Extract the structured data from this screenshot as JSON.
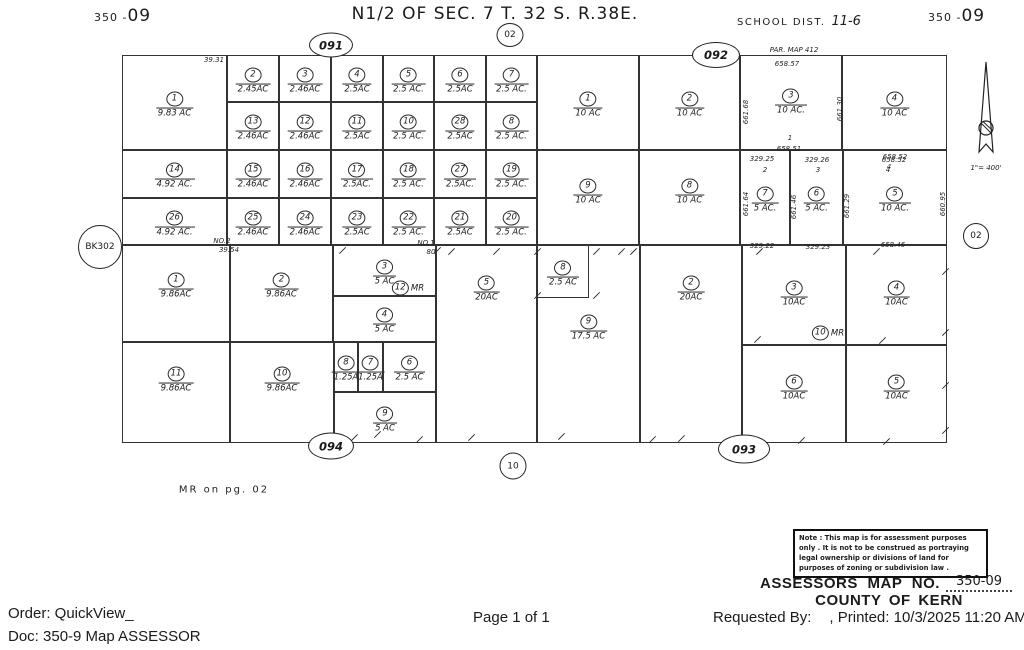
{
  "colors": {
    "paper": "#ffffff",
    "line": "#333333",
    "ink": "#1b1b1b"
  },
  "header": {
    "sheet_prefix": "350 -",
    "sheet_number": "09",
    "title": "N1/2 OF SEC. 7  T. 32 S. R.38E.",
    "school_label": "SCHOOL DIST.",
    "school_value": "11-6"
  },
  "map": {
    "parcels": [
      {
        "n": "1",
        "a": "9.83 AC",
        "x": 122,
        "y": 55,
        "w": 105,
        "h": 95
      },
      {
        "n": "2",
        "a": "2.45AC",
        "x": 227,
        "y": 55,
        "w": 52,
        "h": 47
      },
      {
        "n": "3",
        "a": "2.46AC",
        "x": 279,
        "y": 55,
        "w": 52,
        "h": 47
      },
      {
        "n": "4",
        "a": "2.5AC",
        "x": 331,
        "y": 55,
        "w": 52,
        "h": 47
      },
      {
        "n": "5",
        "a": "2.5 AC.",
        "x": 383,
        "y": 55,
        "w": 51,
        "h": 47
      },
      {
        "n": "6",
        "a": "2.5AC",
        "x": 434,
        "y": 55,
        "w": 52,
        "h": 47
      },
      {
        "n": "7",
        "a": "2.5 AC.",
        "x": 486,
        "y": 55,
        "w": 51,
        "h": 47
      },
      {
        "n": "13",
        "a": "2.46AC",
        "x": 227,
        "y": 102,
        "w": 52,
        "h": 48
      },
      {
        "n": "12",
        "a": "2.46AC",
        "x": 279,
        "y": 102,
        "w": 52,
        "h": 48
      },
      {
        "n": "11",
        "a": "2.5AC",
        "x": 331,
        "y": 102,
        "w": 52,
        "h": 48
      },
      {
        "n": "10",
        "a": "2.5 AC.",
        "x": 383,
        "y": 102,
        "w": 51,
        "h": 48
      },
      {
        "n": "28",
        "a": "2.5AC",
        "x": 434,
        "y": 102,
        "w": 52,
        "h": 48
      },
      {
        "n": "8",
        "a": "2.5 AC.",
        "x": 486,
        "y": 102,
        "w": 51,
        "h": 48
      },
      {
        "n": "14",
        "a": "4.92 AC.",
        "x": 122,
        "y": 150,
        "w": 105,
        "h": 48
      },
      {
        "n": "15",
        "a": "2.46AC",
        "x": 227,
        "y": 150,
        "w": 52,
        "h": 48
      },
      {
        "n": "16",
        "a": "2.46AC",
        "x": 279,
        "y": 150,
        "w": 52,
        "h": 48
      },
      {
        "n": "17",
        "a": "2.5AC.",
        "x": 331,
        "y": 150,
        "w": 52,
        "h": 48
      },
      {
        "n": "18",
        "a": "2.5 AC.",
        "x": 383,
        "y": 150,
        "w": 51,
        "h": 48
      },
      {
        "n": "27",
        "a": "2.5AC.",
        "x": 434,
        "y": 150,
        "w": 52,
        "h": 48
      },
      {
        "n": "19",
        "a": "2.5 AC.",
        "x": 486,
        "y": 150,
        "w": 51,
        "h": 48
      },
      {
        "n": "26",
        "a": "4.92 AC.",
        "x": 122,
        "y": 198,
        "w": 105,
        "h": 47
      },
      {
        "n": "25",
        "a": "2.46AC",
        "x": 227,
        "y": 198,
        "w": 52,
        "h": 47
      },
      {
        "n": "24",
        "a": "2.46AC",
        "x": 279,
        "y": 198,
        "w": 52,
        "h": 47
      },
      {
        "n": "23",
        "a": "2.5AC",
        "x": 331,
        "y": 198,
        "w": 52,
        "h": 47
      },
      {
        "n": "22",
        "a": "2.5 AC.",
        "x": 383,
        "y": 198,
        "w": 51,
        "h": 47
      },
      {
        "n": "21",
        "a": "2.5AC",
        "x": 434,
        "y": 198,
        "w": 52,
        "h": 47
      },
      {
        "n": "20",
        "a": "2.5 AC.",
        "x": 486,
        "y": 198,
        "w": 51,
        "h": 47
      },
      {
        "n": "1",
        "a": "10 AC",
        "x": 537,
        "y": 55,
        "w": 102,
        "h": 95
      },
      {
        "n": "2",
        "a": "10 AC",
        "x": 639,
        "y": 55,
        "w": 101,
        "h": 95
      },
      {
        "n": "3",
        "a": "10 AC.",
        "x": 740,
        "y": 55,
        "w": 102,
        "h": 95,
        "ly": 100
      },
      {
        "n": "4",
        "a": "10 AC",
        "x": 842,
        "y": 55,
        "w": 105,
        "h": 95,
        "ly": 103
      },
      {
        "n": "9",
        "a": "10 AC",
        "x": 537,
        "y": 150,
        "w": 102,
        "h": 95,
        "ly": 190
      },
      {
        "n": "8",
        "a": "10 AC",
        "x": 639,
        "y": 150,
        "w": 101,
        "h": 95,
        "ly": 190
      },
      {
        "n": "7",
        "a": "5 AC.",
        "x": 740,
        "y": 150,
        "w": 50,
        "h": 95,
        "ly": 198
      },
      {
        "n": "6",
        "a": "5 AC.",
        "x": 790,
        "y": 150,
        "w": 53,
        "h": 95,
        "ly": 198
      },
      {
        "n": "5",
        "a": "10 AC.",
        "x": 843,
        "y": 150,
        "w": 104,
        "h": 95,
        "ly": 198
      },
      {
        "n": "1",
        "a": "9.86AC",
        "x": 122,
        "y": 245,
        "w": 108,
        "h": 97,
        "ly": 284
      },
      {
        "n": "2",
        "a": "9.86AC",
        "x": 230,
        "y": 245,
        "w": 103,
        "h": 97,
        "ly": 284
      },
      {
        "n": "3",
        "a": "5 AC",
        "x": 333,
        "y": 245,
        "w": 103,
        "h": 51
      },
      {
        "n": "4",
        "a": "5 AC",
        "x": 333,
        "y": 296,
        "w": 103,
        "h": 46
      },
      {
        "n": "11",
        "a": "9.86AC",
        "x": 122,
        "y": 342,
        "w": 108,
        "h": 101,
        "ly": 378
      },
      {
        "n": "10",
        "a": "9.86AC",
        "x": 230,
        "y": 342,
        "w": 104,
        "h": 101,
        "ly": 378
      },
      {
        "n": "8",
        "a": "1.25A",
        "x": 334,
        "y": 342,
        "w": 24,
        "h": 50
      },
      {
        "n": "7",
        "a": "1.25A",
        "x": 358,
        "y": 342,
        "w": 25,
        "h": 50
      },
      {
        "n": "6",
        "a": "2.5 AC",
        "x": 383,
        "y": 342,
        "w": 53,
        "h": 50
      },
      {
        "n": "9",
        "a": "5 AC",
        "x": 334,
        "y": 392,
        "w": 102,
        "h": 51
      },
      {
        "n": "5",
        "a": "20AC",
        "x": 436,
        "y": 245,
        "w": 101,
        "h": 198,
        "ly": 287
      },
      {
        "n": "9",
        "a": "17.5 AC",
        "x": 537,
        "y": 245,
        "w": 103,
        "h": 198,
        "ly": 326
      },
      {
        "n": "8",
        "a": "2.5 AC",
        "x": 537,
        "y": 245,
        "w": 52,
        "h": 53
      },
      {
        "n": "2",
        "a": "20AC",
        "x": 640,
        "y": 245,
        "w": 102,
        "h": 198,
        "ly": 287
      },
      {
        "n": "3",
        "a": "10AC",
        "x": 742,
        "y": 245,
        "w": 104,
        "h": 100,
        "ly": 292
      },
      {
        "n": "4",
        "a": "10AC",
        "x": 846,
        "y": 245,
        "w": 101,
        "h": 100,
        "ly": 292
      },
      {
        "n": "6",
        "a": "10AC",
        "x": 742,
        "y": 345,
        "w": 104,
        "h": 98,
        "ly": 386
      },
      {
        "n": "5",
        "a": "10AC",
        "x": 846,
        "y": 345,
        "w": 101,
        "h": 98,
        "ly": 386
      }
    ],
    "labels": [
      {
        "t": "39.31",
        "x": 214,
        "y": 60
      },
      {
        "t": "NO.2",
        "x": 222,
        "y": 241
      },
      {
        "t": "39.54",
        "x": 229,
        "y": 250
      },
      {
        "t": "NO.1",
        "x": 426,
        "y": 243
      },
      {
        "t": "80",
        "x": 431,
        "y": 252
      },
      {
        "t": "PAR. MAP  412",
        "x": 794,
        "y": 50
      },
      {
        "t": "658.57",
        "x": 787,
        "y": 64
      },
      {
        "t": "1",
        "x": 790,
        "y": 138
      },
      {
        "t": "658.51",
        "x": 789,
        "y": 149
      },
      {
        "t": "329.25",
        "x": 762,
        "y": 159
      },
      {
        "t": "2",
        "x": 765,
        "y": 170
      },
      {
        "t": "329.26",
        "x": 817,
        "y": 160
      },
      {
        "t": "3",
        "x": 818,
        "y": 170
      },
      {
        "t": "658.52",
        "x": 894,
        "y": 160
      },
      {
        "t": "4",
        "x": 888,
        "y": 170
      },
      {
        "t": "329.22",
        "x": 762,
        "y": 246
      },
      {
        "t": "329.23",
        "x": 818,
        "y": 247
      },
      {
        "t": "658.46",
        "x": 893,
        "y": 245
      },
      {
        "t": "661.68",
        "x": 746,
        "y": 112,
        "r": 1
      },
      {
        "t": "661.30",
        "x": 840,
        "y": 109,
        "r": 1
      },
      {
        "t": "661.64",
        "x": 746,
        "y": 204,
        "r": 1
      },
      {
        "t": "661.46",
        "x": 794,
        "y": 207,
        "r": 1
      },
      {
        "t": "661.29",
        "x": 847,
        "y": 206,
        "r": 1
      },
      {
        "t": "660.95",
        "x": 943,
        "y": 204,
        "r": 1
      },
      {
        "t": "658.52",
        "x": 895,
        "y": 157
      },
      {
        "t": "4",
        "x": 889,
        "y": 167
      },
      {
        "t": "1\"= 400'",
        "x": 986,
        "y": 168
      },
      {
        "t": "MR on pg. 02",
        "x": 224,
        "y": 490,
        "cls": "print"
      }
    ],
    "badges": [
      {
        "t": "091",
        "x": 331,
        "y": 45,
        "w": 42,
        "h": 23,
        "cls": "oval"
      },
      {
        "t": "02",
        "x": 510,
        "y": 35,
        "w": 25,
        "h": 22,
        "cls": "circ"
      },
      {
        "t": "092",
        "x": 716,
        "y": 55,
        "w": 46,
        "h": 24,
        "cls": "oval"
      },
      {
        "t": "02",
        "x": 976,
        "y": 236,
        "w": 24,
        "h": 24,
        "cls": "circ"
      },
      {
        "t": "BK302",
        "x": 100,
        "y": 247,
        "w": 42,
        "h": 42,
        "cls": "circ"
      },
      {
        "t": "094",
        "x": 331,
        "y": 446,
        "w": 44,
        "h": 25,
        "cls": "oval"
      },
      {
        "t": "093",
        "x": 744,
        "y": 449,
        "w": 50,
        "h": 27,
        "cls": "oval"
      },
      {
        "t": "10",
        "x": 513,
        "y": 466,
        "w": 25,
        "h": 25,
        "cls": "circ"
      }
    ],
    "mr_notes": [
      {
        "n": "12",
        "t": "MR",
        "x": 408,
        "y": 288
      },
      {
        "n": "10",
        "t": "MR",
        "x": 828,
        "y": 333
      }
    ],
    "ticks": [
      [
        338,
        250
      ],
      [
        433,
        250
      ],
      [
        447,
        251
      ],
      [
        492,
        251
      ],
      [
        533,
        251
      ],
      [
        592,
        251
      ],
      [
        617,
        251
      ],
      [
        629,
        251
      ],
      [
        755,
        251
      ],
      [
        872,
        251
      ],
      [
        533,
        295
      ],
      [
        592,
        295
      ],
      [
        753,
        339
      ],
      [
        878,
        340
      ],
      [
        941,
        271
      ],
      [
        941,
        332
      ],
      [
        941,
        385
      ],
      [
        941,
        430
      ],
      [
        350,
        437
      ],
      [
        373,
        434
      ],
      [
        415,
        439
      ],
      [
        467,
        437
      ],
      [
        557,
        436
      ],
      [
        648,
        439
      ],
      [
        677,
        438
      ],
      [
        797,
        440
      ],
      [
        882,
        441
      ]
    ],
    "north_scale": "1\"= 400'"
  },
  "notice": {
    "lines": [
      "Note : This map is for assessment purposes",
      "only . It is not to be construed as portraying",
      "legal ownership or divisions of land for",
      "purposes of zoning or subdivision law ."
    ]
  },
  "assessor": {
    "label": "ASSESSORS  MAP  NO.",
    "number": "350-09",
    "county": "COUNTY  OF  KERN"
  },
  "footer": {
    "order": "Order: QuickView_",
    "doc": "Doc: 350-9 Map ASSESSOR",
    "page": "Page 1 of 1",
    "requested": "Requested By:",
    "printed": ", Printed: 10/3/2025 11:20 AM"
  }
}
